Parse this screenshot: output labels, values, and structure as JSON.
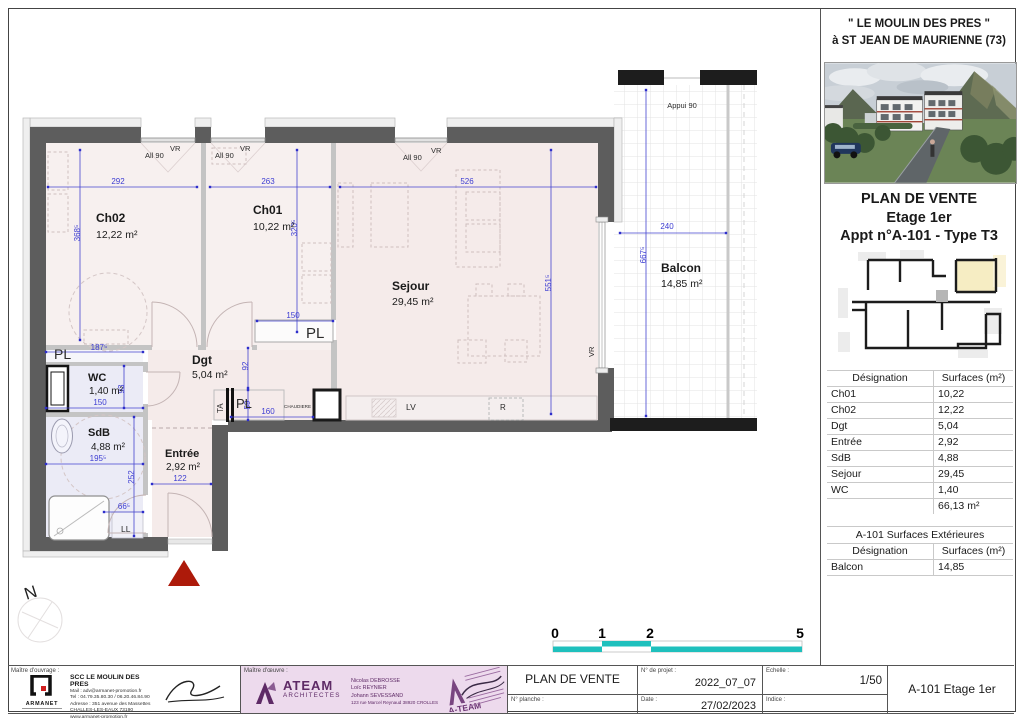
{
  "panel": {
    "line1": "\" LE MOULIN DES PRES \"",
    "line2": "à ST JEAN DE MAURIENNE (73)",
    "doc_title": "PLAN DE VENTE",
    "floor": "Etage 1er",
    "apt": "Appt n°A-101 - Type T3",
    "table_header": {
      "designation": "Désignation",
      "surfaces": "Surfaces (m²)"
    },
    "surfaces_rows": [
      {
        "name": "Ch01",
        "value": "10,22"
      },
      {
        "name": "Ch02",
        "value": "12,22"
      },
      {
        "name": "Dgt",
        "value": "5,04"
      },
      {
        "name": "Entrée",
        "value": "2,92"
      },
      {
        "name": "SdB",
        "value": "4,88"
      },
      {
        "name": "Sejour",
        "value": "29,45"
      },
      {
        "name": "WC",
        "value": "1,40"
      }
    ],
    "total": "66,13 m²",
    "ext_title": "A-101 Surfaces Extérieures",
    "ext_rows": [
      {
        "name": "Balcon",
        "value": "14,85"
      }
    ]
  },
  "plan": {
    "rooms": {
      "ch02": {
        "name": "Ch02",
        "area": "12,22 m²"
      },
      "ch01": {
        "name": "Ch01",
        "area": "10,22 m²"
      },
      "sejour": {
        "name": "Sejour",
        "area": "29,45 m²"
      },
      "dgt": {
        "name": "Dgt",
        "area": "5,04 m²"
      },
      "entree": {
        "name": "Entrée",
        "area": "2,92 m²"
      },
      "wc": {
        "name": "WC",
        "area": "1,40 m²"
      },
      "sdb": {
        "name": "SdB",
        "area": "4,88 m²"
      },
      "balcon": {
        "name": "Balcon",
        "area": "14,85 m²"
      }
    },
    "dims": {
      "ch02_w": "292",
      "ch01_w": "263",
      "sejour_w": "526",
      "ch02_h": "368⁵",
      "ch01_h": "320⁵",
      "sejour_h": "551⁵",
      "balcon_w": "240",
      "balcon_h": "667⁵",
      "pl150": "150",
      "wc_w": "150",
      "wc_h": "93",
      "sdb_w": "195⁵",
      "sdb_h": "252",
      "sdb_s": "66⁵",
      "entree_w": "122",
      "dgt_a": "92",
      "dgt_b": "59",
      "dgt_c": "160",
      "nook": "187⁵"
    },
    "labels": {
      "all90": "All 90",
      "vr": "VR",
      "appui": "Appui 90",
      "pl": "PL",
      "ta": "TA",
      "ll": "LL",
      "chaudiere": "CHAUDIERE",
      "lv": "LV",
      "r": "R",
      "north": "N"
    },
    "scale": {
      "n0": "0",
      "n1": "1",
      "n2": "2",
      "n5": "5"
    }
  },
  "footer": {
    "mo_label": "Maître d'ouvrage :",
    "mo_name": "SCC LE MOULIN DES PRES",
    "mo_lines": [
      "Mail : adv@armanet-promotion.fr",
      "Tel : 04.79.35.80.30 / 06.20.46.84.90",
      "Adresse : 351 avenue des Massettes",
      "CHALLES-LES-EAUX 73190",
      "www.armanet-promotion.fr"
    ],
    "mo_logo": "ARMANET",
    "moe_label": "Maître d'œuvre :",
    "moe_logo": "ATEAM",
    "moe_logo_sub": "ARCHITECTES",
    "moe_names": [
      "Nicolas DEBROSSE",
      "Loïc REYNIER",
      "Johann SEVESSAND",
      "123 rue Marcel Reynaud 38920 CROLLES"
    ],
    "stamp": "A-TEAM",
    "cell_title": "PLAN DE VENTE",
    "planche_label": "N° planche :",
    "projet_label": "N° de projet :",
    "projet_value": "2022_07_07",
    "date_label": "Date :",
    "date_value": "27/02/2023",
    "echelle_label": "Echelle :",
    "echelle_value": "1/50",
    "indice_label": "Indice :",
    "ref": "A-101 Etage 1er"
  }
}
